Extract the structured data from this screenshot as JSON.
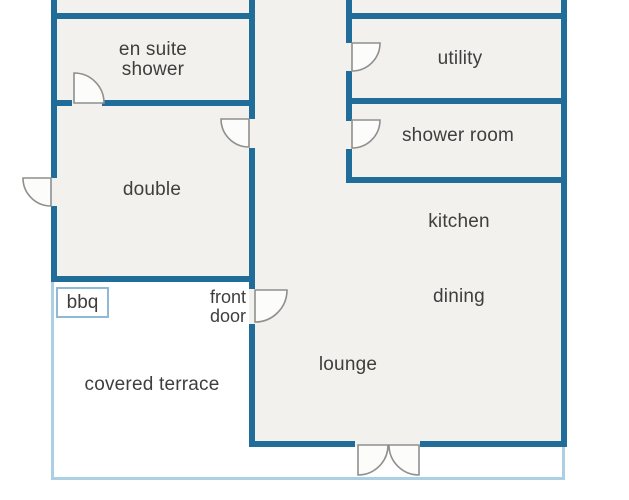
{
  "floorplan": {
    "type": "residential floor plan",
    "labels": {
      "ensuite_line1": "en suite",
      "ensuite_line2": "shower",
      "double": "double",
      "utility": "utility",
      "shower_room": "shower room",
      "kitchen": "kitchen",
      "dining": "dining",
      "lounge": "lounge",
      "covered_terrace": "covered terrace",
      "bbq": "bbq",
      "front_door_line1": "front",
      "front_door_line2": "door"
    },
    "colors": {
      "wall": "#216d9a",
      "terrace_outline": "#abcfe3",
      "bbq_outline": "#8fb9d6",
      "room_fill": "#f2f1ee",
      "outside_fill": "#ffffff",
      "door_symbol": "#8f8f8f",
      "text": "#3e3e3e"
    }
  }
}
